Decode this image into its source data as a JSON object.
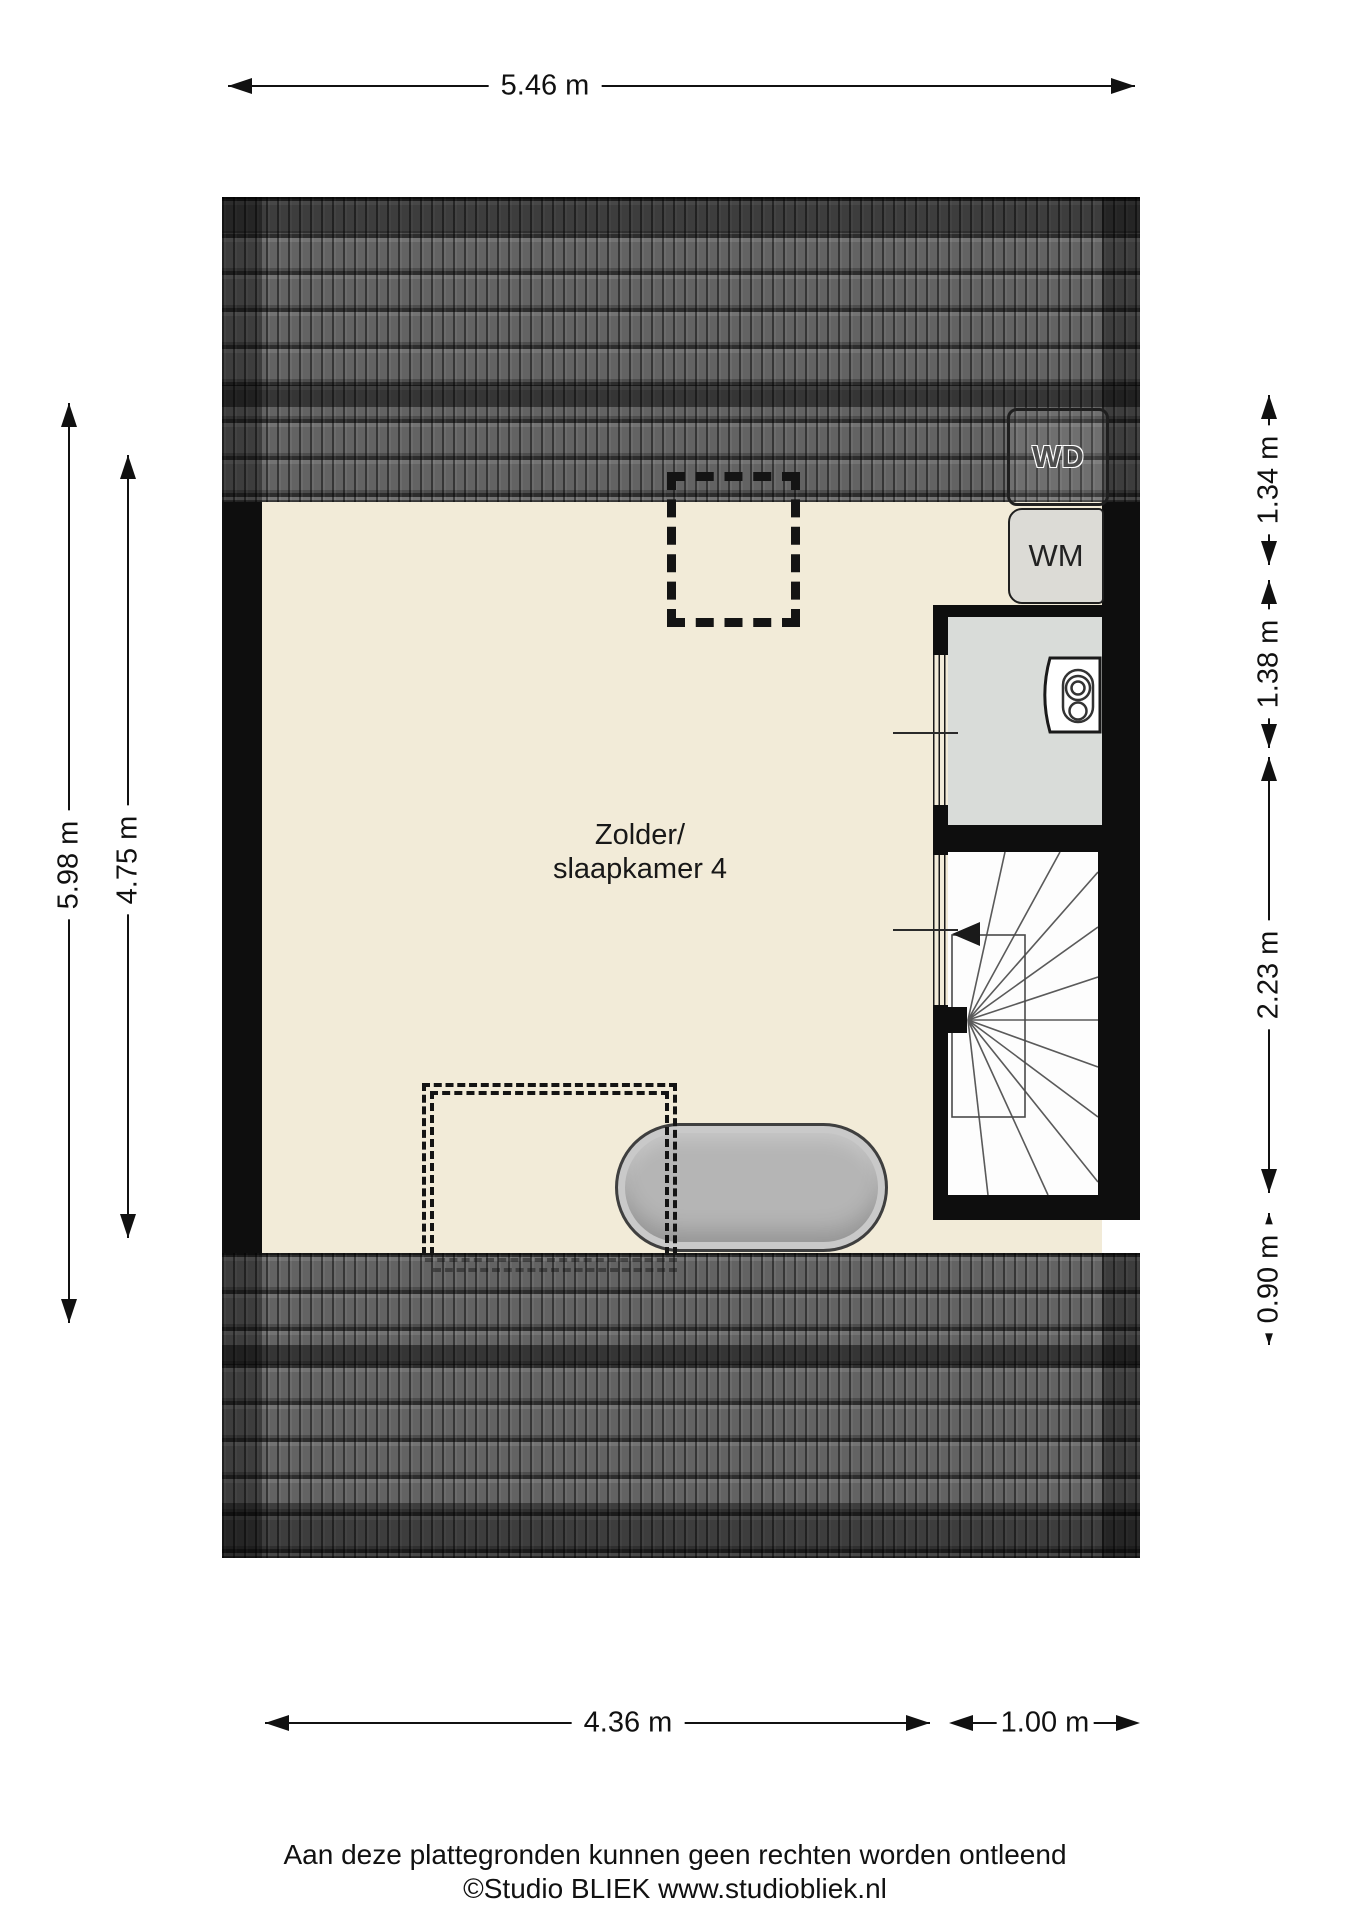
{
  "room": {
    "label_line1": "Zolder/",
    "label_line2": "slaapkamer 4"
  },
  "appliances": {
    "dryer_label": "WD",
    "washer_label": "WM"
  },
  "dimensions": {
    "top": [
      {
        "label": "5.46 m"
      }
    ],
    "bottom": [
      {
        "label": "4.36 m"
      },
      {
        "label": "1.00 m"
      }
    ],
    "left": [
      {
        "label": "5.98 m"
      },
      {
        "label": "4.75 m"
      }
    ],
    "right": [
      {
        "label": "1.34 m"
      },
      {
        "label": "1.38 m"
      },
      {
        "label": "2.23 m"
      },
      {
        "label": "0.90 m"
      }
    ]
  },
  "footer": {
    "line1": "Aan deze plattegronden kunnen geen rechten worden ontleend",
    "line2": "©Studio BLIEK www.studiobliek.nl"
  },
  "colors": {
    "floor": "#f2ebd8",
    "roof_tile": "#636363",
    "wall": "#0e0e0e",
    "boiler_room_floor": "#d9dcd9",
    "stair_floor": "#fdfdfd",
    "tub_fill": "#b5b5b5",
    "appliance_fill": "#dcdbd6",
    "dimension_text": "#111111"
  },
  "icons": {
    "roof": "roof-tiles-texture",
    "stairs": "winder-staircase-icon",
    "bath": "bathtub-icon",
    "boiler": "boiler-icon",
    "direction": "stair-direction-arrow-icon"
  }
}
